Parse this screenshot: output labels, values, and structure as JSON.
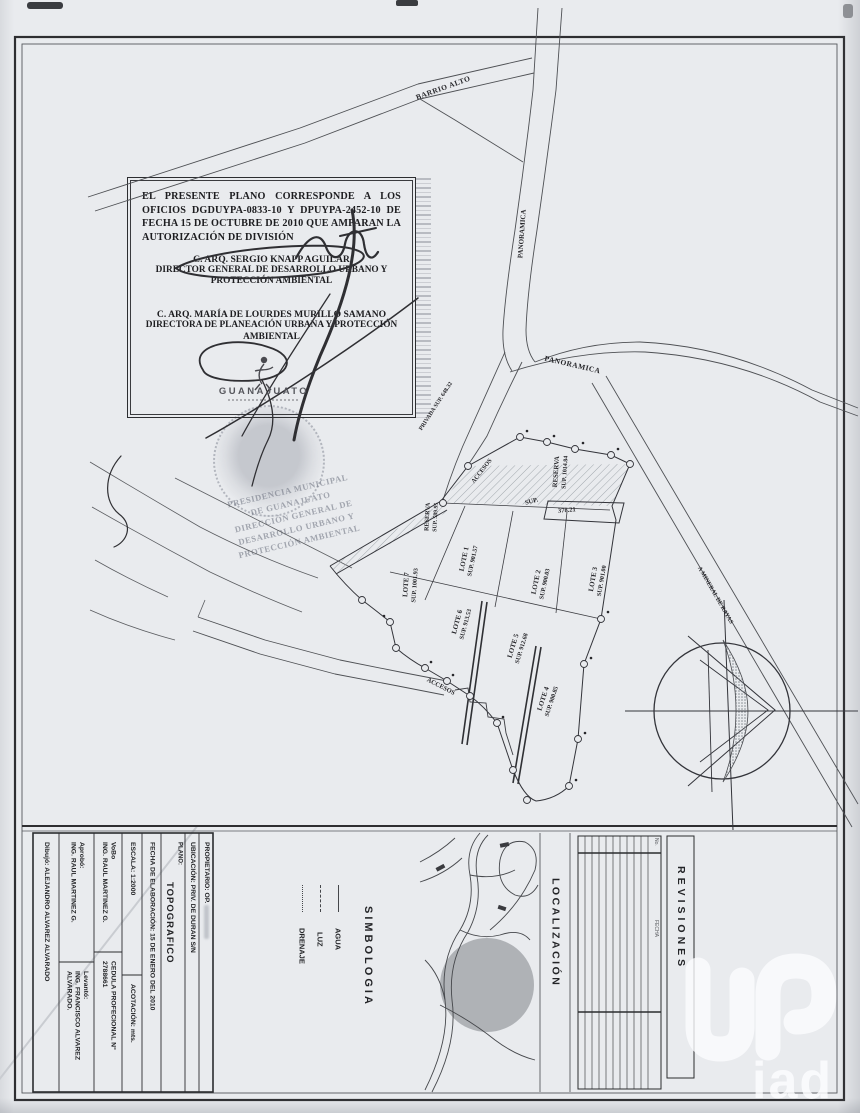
{
  "approval": {
    "paragraph": "EL PRESENTE PLANO CORRESPONDE A LOS OFICIOS DGDUYPA-0833-10 Y DPUYPA-2452-10 DE FECHA 15 DE OCTUBRE DE 2010 QUE AMPARAN LA AUTORIZACIÓN DE DIVISIÓN",
    "official1_name": "C. ARQ. SERGIO KNAPP AGUILAR",
    "official1_title": "DIRECTOR GENERAL DE DESARROLLO URBANO Y PROTECCIÓN AMBIENTAL",
    "official2_name": "C. ARQ. MARÍA DE LOURDES MURILLO SAMANO",
    "official2_title": "DIRECTORA DE PLANEACIÓN URBANA Y PROTECCIÓN AMBIENTAL",
    "logo_text": "GUANAJUATO"
  },
  "stamp": {
    "line1": "PRESIDENCIA MUNICIPAL",
    "line2": "DE GUANAJUATO",
    "line3": "DIRECCIÓN GENERAL DE",
    "line4": "DESARROLLO URBANO Y",
    "line5": "PROTECCIÓN AMBIENTAL"
  },
  "map": {
    "road_barrio_alto": "BARRIO ALTO",
    "road_panoramica_1": "PANORAMICA",
    "road_panoramica_2": "PANORAMICA",
    "road_mineral": "A MINERAL DE RAYAS",
    "road_privada": "PRIVADA SUP. 648.32",
    "road_accesos_1": "ACCESOS",
    "road_accesos_2": "ACCESOS",
    "sup_label": "SUP.",
    "sup_value": "378.21",
    "reserva1_name": "RESERVA",
    "reserva1_sup": "SUP. 1014.84",
    "reserva2_name": "RESERVA",
    "reserva2_sup": "SUP. 589.95",
    "lots": [
      {
        "name": "LOTE 1",
        "sup": "SUP. 901.57"
      },
      {
        "name": "LOTE 2",
        "sup": "SUP. 900.03"
      },
      {
        "name": "LOTE 3",
        "sup": "SUP. 901.00"
      },
      {
        "name": "LOTE 4",
        "sup": "SUP. 900.85"
      },
      {
        "name": "LOTE 5",
        "sup": "SUP. 912.68"
      },
      {
        "name": "LOTE 6",
        "sup": "SUP. 913.53"
      },
      {
        "name": "LOTE 7",
        "sup": "SUP. 1001.93"
      }
    ]
  },
  "titleblock": {
    "dibujo_label": "Dibujó:",
    "dibujo_value": "ALEJANDRO ALVAREZ ALVARADO",
    "aprobo_label": "Aprobó:",
    "aprobo_value": "ING. RAUL MARTINEZ G.",
    "levanto_label": "Levantó:",
    "levanto_value": "ING. FRANCISCO ALVAREZ ALVARADO.",
    "vobo_label": "VoBo",
    "vobo_value": "ING. RAUL MARTINEZ G.",
    "cedula_label": "CEDULA PROFECIONAL N°",
    "cedula_value": "2788661",
    "escala_label": "ESCALA:",
    "escala_value": "1:2000",
    "acotacion_label": "ACOTACIÓN:",
    "acotacion_value": "mts.",
    "fecha": "FECHA DE ELABORACIÓN: 15 DE ENERO DEL 2010",
    "plano_label": "PLANO:",
    "plano_value": "TOPOGRAFICO",
    "ubicacion": "UBICACIÓN: PRIV. DE DURAN S/N",
    "propietario_label": "PROPIETARIO:",
    "propietario_value": "OP."
  },
  "simbologia": {
    "title": "SIMBOLOGIA",
    "items": [
      "AGUA",
      "LUZ",
      "DRENAJE"
    ]
  },
  "localizacion": {
    "title": "LOCALIZACIÓN"
  },
  "revisiones": {
    "title": "REVISIONES",
    "col_no": "No.",
    "col_fecha": "FECHA"
  },
  "watermark": {
    "text": "iad"
  }
}
